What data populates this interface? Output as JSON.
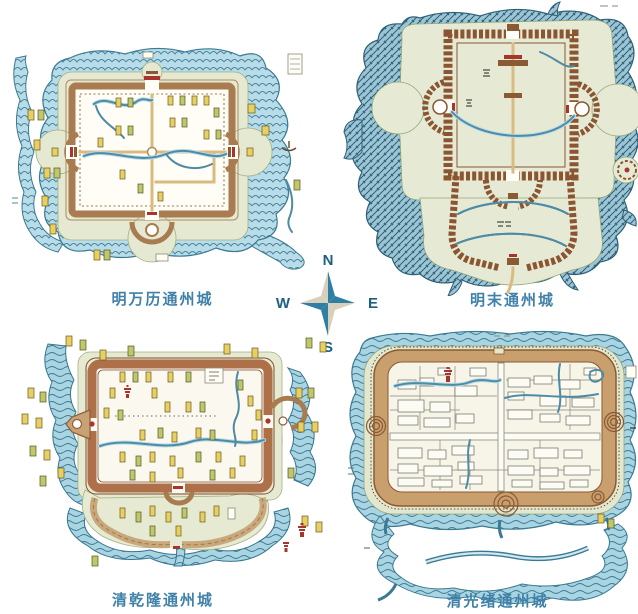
{
  "figure": {
    "description_visible_text_only": true,
    "background": "#ffffff"
  },
  "compass": {
    "north": "N",
    "east": "E",
    "south": "S",
    "west": "W",
    "star_blue": "#2e7fa3",
    "star_beige": "#d8d0bc",
    "letter_color": "#1d6080"
  },
  "maps": [
    {
      "id": "ming-wanli",
      "caption": "明万历通州城"
    },
    {
      "id": "ming-late",
      "caption": "明末通州城"
    },
    {
      "id": "qing-qianlong",
      "caption": "清乾隆通州城"
    },
    {
      "id": "qing-guangxu",
      "caption": "清光绪通州城"
    }
  ],
  "colors": {
    "caption_text": "#3f81a8",
    "water_light": "#b8dce8",
    "water_mid": "#9cc6d6",
    "water_stroke": "#3c7a93",
    "wall_brown": "#a87c50",
    "brick_brown": "#8a5530",
    "qianlong_wall": "#ad7048",
    "guangxu_wall": "#c9a06d",
    "ground_green": "#e5e9d2",
    "label_yellow": "#e8cf63",
    "accent_red": "#a8342e"
  }
}
